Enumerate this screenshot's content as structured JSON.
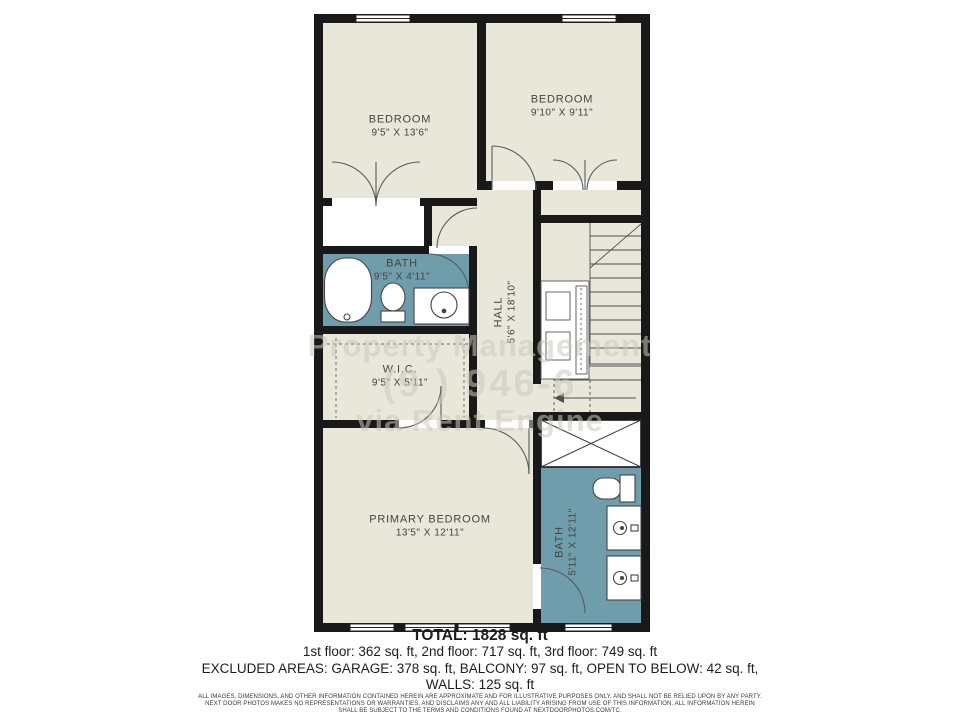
{
  "colors": {
    "wall": "#191919",
    "floor": "#e9e6da",
    "bath_teal": "#6f9dac",
    "line": "#4a4a4a",
    "label_text": "#45453f"
  },
  "rooms": {
    "bedroom1": {
      "name": "BEDROOM",
      "dims": "9'5\" X 13'6\""
    },
    "bedroom2": {
      "name": "BEDROOM",
      "dims": "9'10\" X 9'11\""
    },
    "bath1": {
      "name": "BATH",
      "dims": "9'5\" X 4'11\""
    },
    "hall": {
      "name": "HALL",
      "dims": "5'6\" X 18'10\""
    },
    "wic": {
      "name": "W.I.C.",
      "dims": "9'5\" X 5'11\""
    },
    "primary": {
      "name": "PRIMARY BEDROOM",
      "dims": "13'5\" X 12'11\""
    },
    "bath2": {
      "name": "BATH",
      "dims": "5'11\" X 12'11\""
    }
  },
  "watermark": {
    "line1": "Property Management",
    "line2": "(9  ) 946-6",
    "line3": "via Rent Engine"
  },
  "summary": {
    "total": "TOTAL: 1828 sq. ft",
    "floors": "1st floor: 362 sq. ft, 2nd floor: 717 sq. ft, 3rd floor: 749 sq. ft",
    "excluded": "EXCLUDED AREAS: GARAGE: 378 sq. ft, BALCONY: 97 sq. ft, OPEN TO BELOW: 42 sq. ft,",
    "walls": "WALLS: 125 sq. ft"
  },
  "disclaimer": {
    "line1": "ALL IMAGES, DIMENSIONS, AND OTHER INFORMATION CONTAINED HEREIN ARE APPROXIMATE AND FOR ILLUSTRATIVE PURPOSES ONLY, AND SHALL NOT BE RELIED UPON BY ANY PARTY.",
    "line2": "NEXT DOOR PHOTOS MAKES NO REPRESENTATIONS OR WARRANTIES, AND DISCLAIMS ANY AND ALL LIABILITY ARISING FROM USE OF THIS INFORMATION. ALL INFORMATION HEREIN",
    "line3": "SHALL BE SUBJECT TO THE TERMS AND CONDITIONS FOUND AT NEXTDOORPHOTOS.COM/TC."
  }
}
